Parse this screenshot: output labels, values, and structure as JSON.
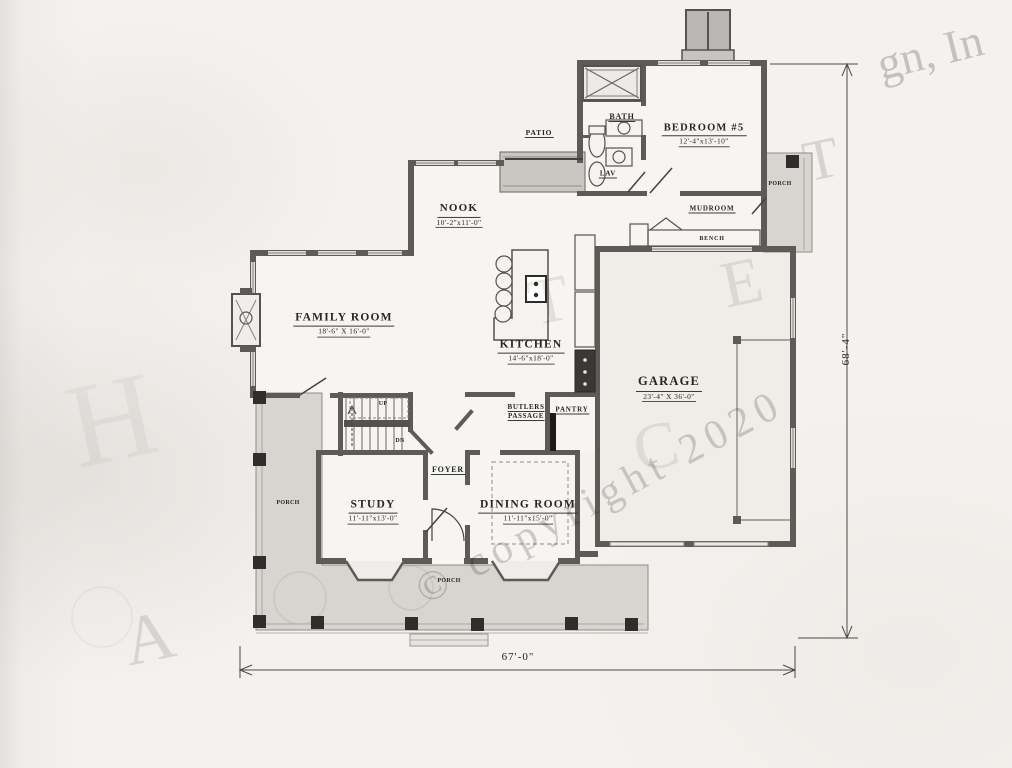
{
  "rooms": [
    {
      "name": "NOOK",
      "dims": "10'-2\"x11'-0\""
    },
    {
      "name": "FAMILY ROOM",
      "dims": "18'-6\" X 16'-0\""
    },
    {
      "name": "KITCHEN",
      "dims": "14'-6\"x18'-0\""
    },
    {
      "name": "GARAGE",
      "dims": "23'-4\" X 36'-0\""
    },
    {
      "name": "BEDROOM #5",
      "dims": "12'-4\"x13'-10\""
    },
    {
      "name": "STUDY",
      "dims": "11'-11\"x13'-0\""
    },
    {
      "name": "DINING ROOM",
      "dims": "11'-11\"x15'-0\""
    }
  ],
  "labels": {
    "bath": "BATH",
    "lav": "LAV",
    "patio": "PATIO",
    "mudroom": "MUDROOM",
    "bench": "BENCH",
    "foyer": "FOYER",
    "butlers_line1": "BUTLERS",
    "butlers_line2": "PASSAGE",
    "pantry": "PANTRY",
    "porch_left": "PORCH",
    "porch_bottom": "PORCH",
    "porch_right": "PORCH",
    "stairs_up": "UP",
    "stairs_down": "DN"
  },
  "overall_dimensions": {
    "width": "67'-0\"",
    "height": "68'-4\""
  },
  "watermark": {
    "corner_fragment": "gn, In",
    "copyright": "© copyright 2020",
    "ghost_letters": [
      "H",
      "T",
      "E",
      "C",
      "T",
      "A"
    ]
  },
  "colors": {
    "paper": "#f4f2ee",
    "wall": "#5d5b57",
    "porch_fill": "#d7d5d0",
    "patio_fill": "#c9c7c2",
    "ink": "#262626"
  }
}
